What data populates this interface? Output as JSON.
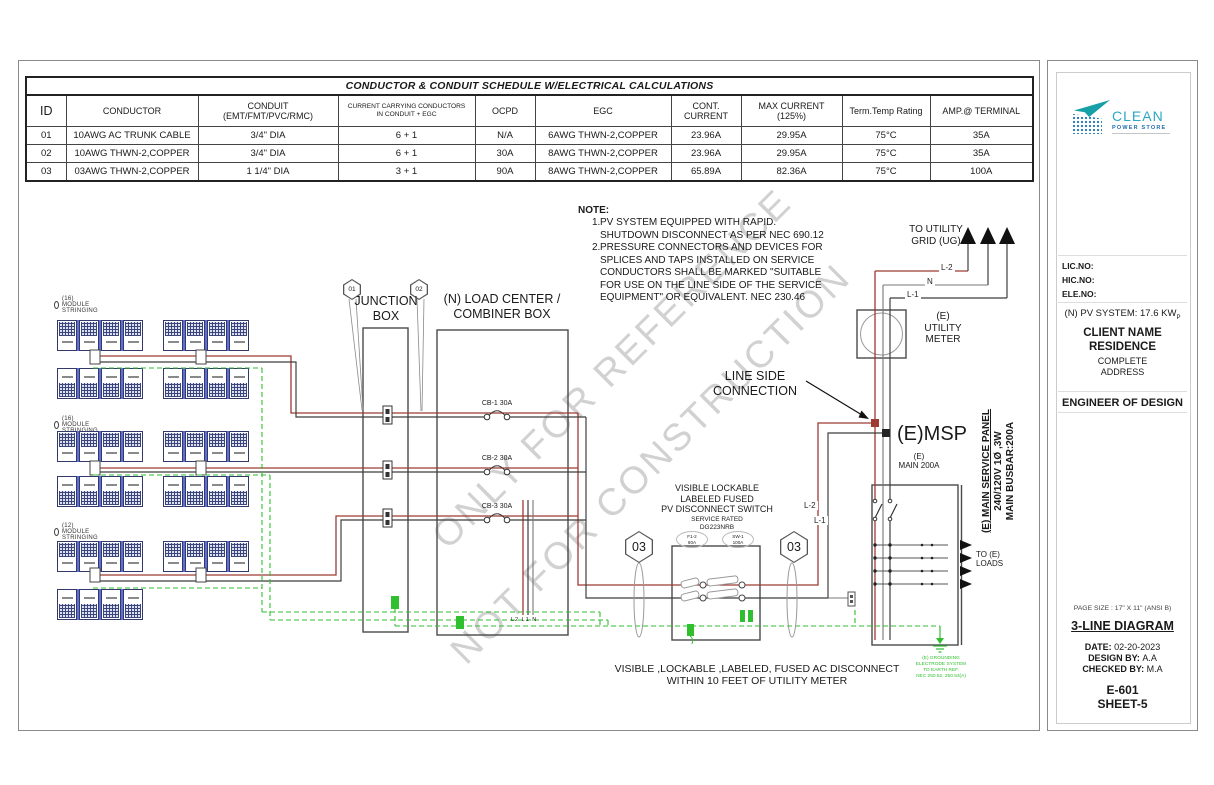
{
  "table": {
    "title": "CONDUCTOR & CONDUIT SCHEDULE W/ELECTRICAL CALCULATIONS",
    "headers": [
      "ID",
      "CONDUCTOR",
      "CONDUIT\n(EMT/FMT/PVC/RMC)",
      "CURRENT CARRYING CONDUCTORS\nIN CONDUIT + EGC",
      "OCPD",
      "EGC",
      "CONT.\nCURRENT",
      "MAX CURRENT (125%)",
      "Term.Temp Rating",
      "AMP.@ TERMINAL"
    ],
    "rows": [
      [
        "01",
        "10AWG AC TRUNK CABLE",
        "3/4\" DIA",
        "6 + 1",
        "N/A",
        "6AWG THWN-2,COPPER",
        "23.96A",
        "29.95A",
        "75°C",
        "35A"
      ],
      [
        "02",
        "10AWG THWN-2,COPPER",
        "3/4\" DIA",
        "6 + 1",
        "30A",
        "8AWG THWN-2,COPPER",
        "23.96A",
        "29.95A",
        "75°C",
        "35A"
      ],
      [
        "03",
        "03AWG THWN-2,COPPER",
        "1 1/4\" DIA",
        "3 + 1",
        "90A",
        "8AWG THWN-2,COPPER",
        "65.89A",
        "82.36A",
        "75°C",
        "100A"
      ]
    ]
  },
  "note": {
    "heading": "NOTE:",
    "items": [
      {
        "num": "1.",
        "text": "PV SYSTEM EQUIPPED WITH RAPID.\nSHUTDOWN DISCONNECT AS PER NEC 690.12"
      },
      {
        "num": "2.",
        "text": "PRESSURE CONNECTORS AND DEVICES FOR\nSPLICES AND TAPS INSTALLED ON SERVICE\nCONDUCTORS SHALL BE MARKED \"SUITABLE\nFOR USE ON THE LINE SIDE OF THE SERVICE\nEQUIPMENT\" OR EQUIVALENT. NEC 230.46"
      }
    ]
  },
  "watermark": {
    "line1": "ONLY FOR REFERENCE",
    "line2": "NOT FOR CONSTRUCTION"
  },
  "diagram": {
    "array_labels": [
      "(16) MODULE STRINGING",
      "(16) MODULE STRINGING",
      "(12) MODULE STRINGING"
    ],
    "junction_box": "JUNCTION BOX",
    "load_center": "(N) LOAD CENTER /\nCOMBINER BOX",
    "hex01": "01",
    "hex02": "02",
    "hex03_left": "03",
    "hex03_right": "03",
    "breakers": [
      "CB-1 30A",
      "CB-2 30A",
      "CB-3 30A"
    ],
    "lc_wires": "L2 L1 N",
    "disconnect": {
      "title": "VISIBLE LOCKABLE\nLABELED FUSED\nPV DISCONNECT SWITCH",
      "subtitle": "SERVICE RATED",
      "model": "DG223NRB",
      "fuse_label": "F1-2",
      "fuse_rating": "60A",
      "switch_label": "SW-1",
      "switch_rating": "100A"
    },
    "riser_l2": "L-2",
    "riser_l1": "L-1",
    "line_side": "LINE SIDE\nCONNECTION",
    "utility": {
      "to_grid": "TO UTILITY\nGRID (UG)",
      "l2": "L-2",
      "n": "N",
      "l1": "L-1",
      "meter": "(E)\nUTILITY\nMETER"
    },
    "msp": {
      "title": "(E)MSP",
      "main": "(E)\nMAIN 200A",
      "panel_line1": "(E) MAIN SERVICE PANEL",
      "panel_line2": "240/120V 1Ø ,3W",
      "panel_line3": "MAIN BUSBAR:200A",
      "to_loads": "TO (E)\nLOADS"
    },
    "ac_disconnect_note": "VISIBLE ,LOCKABLE ,LABELED, FUSED AC DISCONNECT\nWITHIN 10 FEET OF UTILITY METER",
    "grounding_note": "(E) GROUNDING\nELECTRODE SYSTEM\nTO EARTH REF.\nNEC 250.52, 250.53(A)"
  },
  "sidebar": {
    "logo": {
      "name": "CLEAN",
      "tagline": "POWER STORE"
    },
    "license": {
      "lic": "LIC.NO:",
      "hic": "HIC.NO:",
      "ele": "ELE.NO:"
    },
    "system": {
      "text": "(N) PV SYSTEM: 17.6 KW",
      "sub": "P"
    },
    "client_line1": "CLIENT NAME",
    "client_line2": "RESIDENCE",
    "address_line1": "COMPLETE",
    "address_line2": "ADDRESS",
    "engineer": "ENGINEER OF DESIGN",
    "page_size": "PAGE SIZE : 17\" X 11\" (ANSI B)",
    "doc_title": "3-LINE DIAGRAM",
    "date_label": "DATE:",
    "date_value": "02-20-2023",
    "design_label": "DESIGN BY:",
    "design_value": "A.A",
    "checked_label": "CHECKED BY:",
    "checked_value": "M.A",
    "code": "E-601",
    "sheet": "SHEET-5"
  },
  "colors": {
    "wire_red": "#9e3a32",
    "wire_black": "#3f3f3f",
    "ground_green": "#2fbf2f",
    "panel_blue": "#3c4579",
    "logo_teal": "#16a0a8",
    "logo_blue": "#1f6cb0"
  }
}
